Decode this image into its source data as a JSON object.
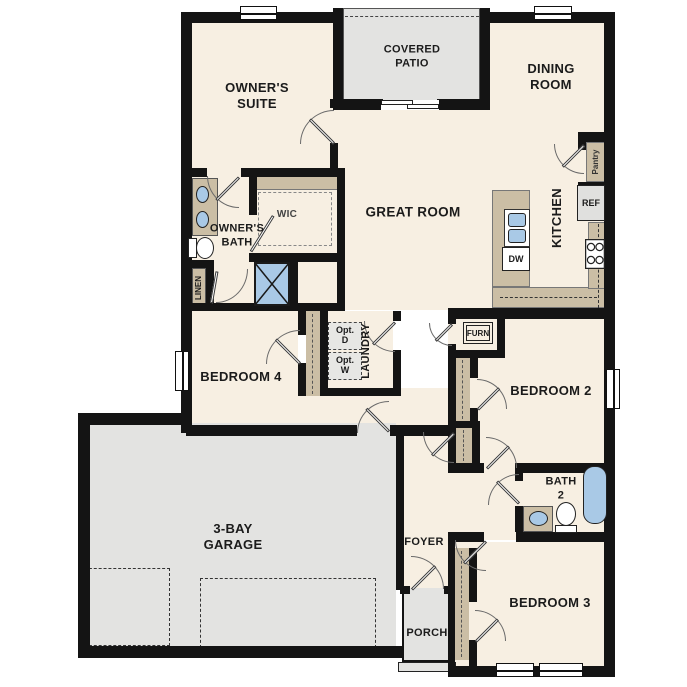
{
  "plan_title": "single-story floor plan",
  "colors": {
    "wall": "#141414",
    "floor": "#f7efe2",
    "hard_floor": "#e3e3e1",
    "cabinet_tan": "#cbbea5",
    "fixture_blue": "#a9c9e6"
  },
  "rooms": {
    "covered_patio": {
      "line1": "COVERED",
      "line2": "PATIO"
    },
    "dining_room": {
      "line1": "DINING",
      "line2": "ROOM"
    },
    "owners_suite": {
      "line1": "OWNER'S",
      "line2": "SUITE"
    },
    "great_room": {
      "label": "GREAT ROOM"
    },
    "owners_bath": {
      "line1": "OWNER'S",
      "line2": "BATH"
    },
    "wic": {
      "label": "WIC"
    },
    "kitchen": {
      "label": "KITCHEN"
    },
    "bedroom4": {
      "label": "BEDROOM 4"
    },
    "laundry": {
      "label": "LAUNDRY"
    },
    "bedroom2": {
      "label": "BEDROOM 2"
    },
    "bath2": {
      "line1": "BATH",
      "line2": "2"
    },
    "garage": {
      "line1": "3-BAY",
      "line2": "GARAGE"
    },
    "foyer": {
      "label": "FOYER"
    },
    "porch": {
      "label": "PORCH"
    },
    "bedroom3": {
      "label": "BEDROOM 3"
    }
  },
  "features": {
    "pantry": "Pantry",
    "linen": "LINEN",
    "ref": "REF",
    "dw": "DW",
    "furn": "FURN",
    "opt_dryer": {
      "line1": "Opt.",
      "line2": "D"
    },
    "opt_washer": {
      "line1": "Opt.",
      "line2": "W"
    }
  }
}
